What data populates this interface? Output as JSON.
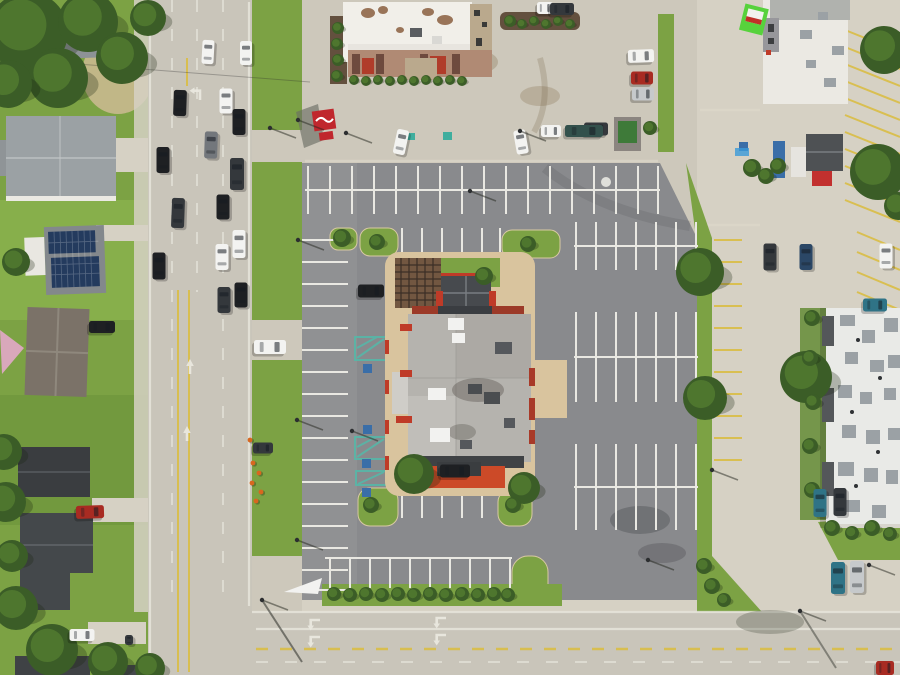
{
  "image_description": "Aerial drone photograph of a commercial restaurant pad site with large parking lot, bordered by a multi-lane road on the west, a cross street on the south, houses on the west side and commercial buildings on the north and east",
  "palette": {
    "grass": "#7ca244",
    "grassLight": "#8fba52",
    "grassDark": "#648c36",
    "treeDark": "#3b5d27",
    "treeLight": "#527a30",
    "conc": "#cdc8bb",
    "concLight": "#d6d1c4",
    "road": "#c9c5ba",
    "asphalt": "#898a8d",
    "asphaltLight": "#97989a",
    "stripe": "#e9e8e2",
    "yellow": "#d9bd45",
    "apron": "#d9c49e",
    "roofWhite": "#f1efe9",
    "roofGray": "#b5b3ae",
    "roofDark": "#474a4e",
    "charcoal": "#3e4144",
    "red": "#bf3b28",
    "redBright": "#cc4a28",
    "signRed": "#c0272d",
    "signGreen": "#57d23c",
    "band": "#b08a74",
    "bandDark": "#6e4a3e",
    "tan": "#baa98d",
    "mulch": "#63503e",
    "hvac": "#9ba1a5",
    "white": "#f2f2f0",
    "pinkSail": "#d9a8bb",
    "solar": "#243b5e",
    "bluebox": "#3a6ea8",
    "dumpGreen": "#3e7a39",
    "cone": "#d8671f",
    "carBlack": "#1e2023",
    "carWhite": "#f3f3f1",
    "carGray": "#73777c",
    "carCharcoal": "#34383c",
    "carNavy": "#2b4766",
    "carTeal": "#2f7386",
    "carRed": "#a82b22",
    "carSilver": "#c6c9cb",
    "carBoat": "#33514c"
  },
  "scene": {
    "vehicles": [
      {
        "x": 180,
        "y": 103,
        "w": 13,
        "h": 26,
        "rot": 2,
        "color": "carBlack"
      },
      {
        "x": 226,
        "y": 101,
        "w": 13,
        "h": 25,
        "rot": 0,
        "color": "carWhite"
      },
      {
        "x": 239,
        "y": 122,
        "w": 13,
        "h": 26,
        "rot": 0,
        "color": "carBlack"
      },
      {
        "x": 211,
        "y": 145,
        "w": 13,
        "h": 27,
        "rot": 2,
        "color": "carGray"
      },
      {
        "x": 237,
        "y": 174,
        "w": 14,
        "h": 32,
        "rot": 0,
        "color": "carCharcoal"
      },
      {
        "x": 163,
        "y": 160,
        "w": 13,
        "h": 26,
        "rot": 0,
        "color": "carBlack"
      },
      {
        "x": 178,
        "y": 213,
        "w": 13,
        "h": 30,
        "rot": 2,
        "color": "carCharcoal"
      },
      {
        "x": 223,
        "y": 207,
        "w": 13,
        "h": 25,
        "rot": 0,
        "color": "carBlack"
      },
      {
        "x": 239,
        "y": 244,
        "w": 13,
        "h": 28,
        "rot": 0,
        "color": "carWhite"
      },
      {
        "x": 222,
        "y": 257,
        "w": 13,
        "h": 26,
        "rot": 0,
        "color": "carWhite"
      },
      {
        "x": 159,
        "y": 266,
        "w": 13,
        "h": 27,
        "rot": 0,
        "color": "carBlack"
      },
      {
        "x": 224,
        "y": 300,
        "w": 13,
        "h": 26,
        "rot": 0,
        "color": "carCharcoal"
      },
      {
        "x": 241,
        "y": 295,
        "w": 13,
        "h": 25,
        "rot": 0,
        "color": "carBlack"
      },
      {
        "x": 208,
        "y": 52,
        "w": 12,
        "h": 24,
        "rot": 3,
        "color": "carWhite"
      },
      {
        "x": 246,
        "y": 53,
        "w": 12,
        "h": 24,
        "rot": 0,
        "color": "carWhite"
      },
      {
        "x": 102,
        "y": 327,
        "w": 12,
        "h": 26,
        "rot": 90,
        "color": "carBlack"
      },
      {
        "x": 90,
        "y": 512,
        "w": 13,
        "h": 28,
        "rot": 88,
        "color": "carRed"
      },
      {
        "x": 82,
        "y": 635,
        "w": 12,
        "h": 25,
        "rot": 90,
        "color": "carWhite"
      },
      {
        "x": 129,
        "y": 640,
        "w": 8,
        "h": 10,
        "rot": 0,
        "color": "carCharcoal"
      },
      {
        "x": 401,
        "y": 142,
        "w": 12,
        "h": 25,
        "rot": 12,
        "color": "carWhite"
      },
      {
        "x": 521,
        "y": 142,
        "w": 12,
        "h": 24,
        "rot": -10,
        "color": "carWhite"
      },
      {
        "x": 596,
        "y": 129,
        "w": 13,
        "h": 24,
        "rot": 90,
        "color": "carCharcoal"
      },
      {
        "x": 551,
        "y": 131,
        "w": 12,
        "h": 20,
        "rot": 90,
        "color": "carWhite"
      },
      {
        "x": 584,
        "y": 131,
        "w": 12,
        "h": 38,
        "rot": 90,
        "color": "carBoat"
      },
      {
        "x": 371,
        "y": 291,
        "w": 13,
        "h": 26,
        "rot": 90,
        "color": "carBlack"
      },
      {
        "x": 455,
        "y": 471,
        "w": 13,
        "h": 30,
        "rot": 90,
        "color": "carBlack"
      },
      {
        "x": 770,
        "y": 257,
        "w": 13,
        "h": 27,
        "rot": 0,
        "color": "carCharcoal"
      },
      {
        "x": 806,
        "y": 257,
        "w": 13,
        "h": 26,
        "rot": 0,
        "color": "carNavy"
      },
      {
        "x": 886,
        "y": 256,
        "w": 13,
        "h": 25,
        "rot": 0,
        "color": "carWhite"
      },
      {
        "x": 875,
        "y": 305,
        "w": 13,
        "h": 24,
        "rot": 90,
        "color": "carTeal"
      },
      {
        "x": 820,
        "y": 503,
        "w": 13,
        "h": 28,
        "rot": 0,
        "color": "carTeal"
      },
      {
        "x": 840,
        "y": 502,
        "w": 13,
        "h": 28,
        "rot": 0,
        "color": "carCharcoal"
      },
      {
        "x": 838,
        "y": 578,
        "w": 14,
        "h": 32,
        "rot": 0,
        "color": "carTeal"
      },
      {
        "x": 857,
        "y": 577,
        "w": 14,
        "h": 32,
        "rot": 0,
        "color": "carSilver"
      },
      {
        "x": 641,
        "y": 56,
        "w": 13,
        "h": 26,
        "rot": 88,
        "color": "carWhite"
      },
      {
        "x": 642,
        "y": 78,
        "w": 13,
        "h": 22,
        "rot": 90,
        "color": "carRed"
      },
      {
        "x": 643,
        "y": 94,
        "w": 13,
        "h": 22,
        "rot": 90,
        "color": "carSilver"
      },
      {
        "x": 545,
        "y": 8,
        "w": 12,
        "h": 16,
        "rot": 90,
        "color": "carWhite"
      },
      {
        "x": 562,
        "y": 9,
        "w": 12,
        "h": 24,
        "rot": 90,
        "color": "carCharcoal"
      },
      {
        "x": 270,
        "y": 347,
        "w": 14,
        "h": 32,
        "rot": 90,
        "color": "carWhite"
      },
      {
        "x": 263,
        "y": 448,
        "w": 11,
        "h": 20,
        "rot": 90,
        "color": "carCharcoal"
      },
      {
        "x": 885,
        "y": 668,
        "w": 14,
        "h": 18,
        "rot": 90,
        "color": "carRed"
      }
    ],
    "trees": [
      {
        "x": 28,
        "y": 32,
        "r": 40
      },
      {
        "x": 88,
        "y": 22,
        "r": 30
      },
      {
        "x": 122,
        "y": 58,
        "r": 26
      },
      {
        "x": 58,
        "y": 78,
        "r": 30
      },
      {
        "x": 8,
        "y": 84,
        "r": 24
      },
      {
        "x": 148,
        "y": 18,
        "r": 18
      },
      {
        "x": 16,
        "y": 262,
        "r": 14
      },
      {
        "x": 4,
        "y": 452,
        "r": 18
      },
      {
        "x": 6,
        "y": 502,
        "r": 20
      },
      {
        "x": 12,
        "y": 556,
        "r": 16
      },
      {
        "x": 16,
        "y": 608,
        "r": 22
      },
      {
        "x": 52,
        "y": 650,
        "r": 26
      },
      {
        "x": 108,
        "y": 662,
        "r": 20
      },
      {
        "x": 150,
        "y": 668,
        "r": 15
      },
      {
        "x": 700,
        "y": 272,
        "r": 24
      },
      {
        "x": 705,
        "y": 398,
        "r": 22
      },
      {
        "x": 414,
        "y": 474,
        "r": 20
      },
      {
        "x": 524,
        "y": 488,
        "r": 16
      },
      {
        "x": 806,
        "y": 377,
        "r": 26
      },
      {
        "x": 884,
        "y": 50,
        "r": 24
      },
      {
        "x": 878,
        "y": 172,
        "r": 28
      },
      {
        "x": 898,
        "y": 206,
        "r": 14
      },
      {
        "x": 650,
        "y": 128,
        "r": 7
      },
      {
        "x": 342,
        "y": 238,
        "r": 9
      },
      {
        "x": 510,
        "y": 21,
        "r": 6
      },
      {
        "x": 522,
        "y": 24,
        "r": 5
      },
      {
        "x": 534,
        "y": 21,
        "r": 5
      },
      {
        "x": 546,
        "y": 24,
        "r": 5
      },
      {
        "x": 558,
        "y": 21,
        "r": 5
      },
      {
        "x": 570,
        "y": 24,
        "r": 5
      },
      {
        "x": 338,
        "y": 28,
        "r": 6
      },
      {
        "x": 337,
        "y": 44,
        "r": 6
      },
      {
        "x": 338,
        "y": 60,
        "r": 6
      },
      {
        "x": 337,
        "y": 76,
        "r": 6
      },
      {
        "x": 354,
        "y": 80,
        "r": 5
      },
      {
        "x": 366,
        "y": 81,
        "r": 5
      },
      {
        "x": 378,
        "y": 80,
        "r": 5
      },
      {
        "x": 390,
        "y": 81,
        "r": 5
      },
      {
        "x": 402,
        "y": 80,
        "r": 5
      },
      {
        "x": 414,
        "y": 81,
        "r": 5
      },
      {
        "x": 426,
        "y": 80,
        "r": 5
      },
      {
        "x": 438,
        "y": 81,
        "r": 5
      },
      {
        "x": 450,
        "y": 80,
        "r": 5
      },
      {
        "x": 462,
        "y": 81,
        "r": 5
      },
      {
        "x": 484,
        "y": 276,
        "r": 9
      },
      {
        "x": 377,
        "y": 242,
        "r": 8
      },
      {
        "x": 528,
        "y": 244,
        "r": 8
      },
      {
        "x": 371,
        "y": 505,
        "r": 8
      },
      {
        "x": 513,
        "y": 505,
        "r": 8
      },
      {
        "x": 334,
        "y": 594,
        "r": 7
      },
      {
        "x": 350,
        "y": 595,
        "r": 7
      },
      {
        "x": 366,
        "y": 594,
        "r": 7
      },
      {
        "x": 382,
        "y": 595,
        "r": 7
      },
      {
        "x": 398,
        "y": 594,
        "r": 7
      },
      {
        "x": 414,
        "y": 595,
        "r": 7
      },
      {
        "x": 430,
        "y": 594,
        "r": 7
      },
      {
        "x": 446,
        "y": 595,
        "r": 7
      },
      {
        "x": 462,
        "y": 594,
        "r": 7
      },
      {
        "x": 478,
        "y": 595,
        "r": 7
      },
      {
        "x": 494,
        "y": 594,
        "r": 7
      },
      {
        "x": 508,
        "y": 595,
        "r": 7
      },
      {
        "x": 752,
        "y": 168,
        "r": 9
      },
      {
        "x": 766,
        "y": 176,
        "r": 8
      },
      {
        "x": 778,
        "y": 166,
        "r": 8
      },
      {
        "x": 812,
        "y": 318,
        "r": 8
      },
      {
        "x": 810,
        "y": 358,
        "r": 8
      },
      {
        "x": 813,
        "y": 402,
        "r": 8
      },
      {
        "x": 810,
        "y": 446,
        "r": 8
      },
      {
        "x": 812,
        "y": 490,
        "r": 8
      },
      {
        "x": 832,
        "y": 528,
        "r": 8
      },
      {
        "x": 852,
        "y": 533,
        "r": 7
      },
      {
        "x": 872,
        "y": 528,
        "r": 8
      },
      {
        "x": 890,
        "y": 534,
        "r": 7
      },
      {
        "x": 704,
        "y": 566,
        "r": 8
      },
      {
        "x": 712,
        "y": 586,
        "r": 8
      },
      {
        "x": 724,
        "y": 600,
        "r": 7
      }
    ],
    "light_poles": [
      {
        "x": 298,
        "y": 120
      },
      {
        "x": 298,
        "y": 240
      },
      {
        "x": 297,
        "y": 420
      },
      {
        "x": 297,
        "y": 540
      },
      {
        "x": 270,
        "y": 128
      },
      {
        "x": 346,
        "y": 133
      },
      {
        "x": 520,
        "y": 131
      },
      {
        "x": 262,
        "y": 600
      },
      {
        "x": 800,
        "y": 611
      },
      {
        "x": 648,
        "y": 560
      },
      {
        "x": 712,
        "y": 470
      },
      {
        "x": 470,
        "y": 191
      },
      {
        "x": 352,
        "y": 431
      },
      {
        "x": 869,
        "y": 565
      }
    ],
    "traffic_cones": [
      {
        "x": 253,
        "y": 463
      },
      {
        "x": 259,
        "y": 473
      },
      {
        "x": 252,
        "y": 483
      },
      {
        "x": 261,
        "y": 492
      },
      {
        "x": 256,
        "y": 501
      },
      {
        "x": 250,
        "y": 440
      }
    ]
  }
}
